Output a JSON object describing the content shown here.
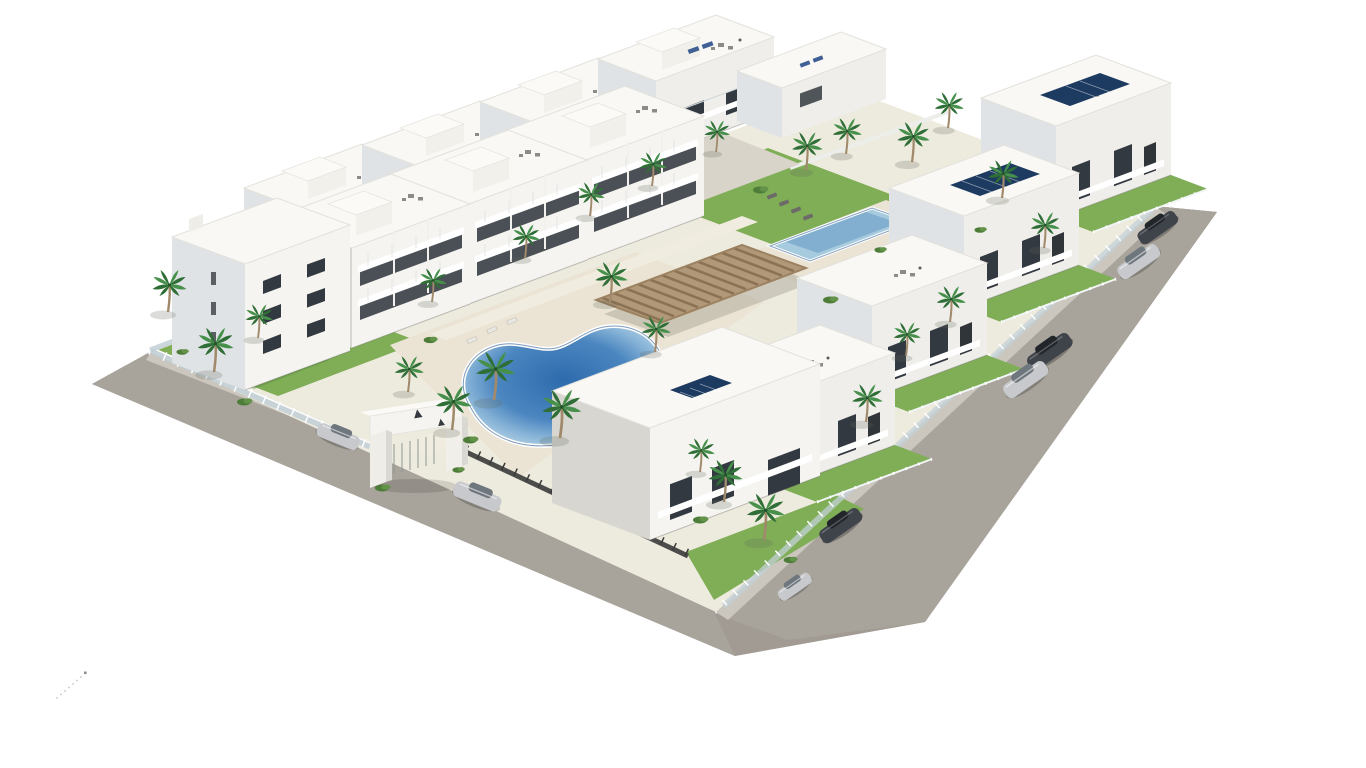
{
  "scene": {
    "description": "Aerial 3D architectural rendering of a white Mediterranean apartment complex with stepped rooftop terraces, solar panels, a free-form pool, a rectangular lap pool, wooden pergola, palm gardens, perimeter road and parked cars",
    "entrance": {
      "logo_glyph": "▲",
      "logo_count": 2
    },
    "palette": {
      "bg": "#ffffff",
      "road": "#a8a39b",
      "road_dark": "#9b968e",
      "sidewalk": "#cbc7bf",
      "sand": "#edeade",
      "alley": "#d8d4c9",
      "deck": "#ebe4d4",
      "path": "#f0ecdf",
      "lawn": "#7fae57",
      "lawn_dark": "#5e8f41",
      "pool_rim": "#27588f",
      "lap_water": "#a6cade",
      "lap_deep": "#6f9fc8",
      "pergola_wood": "#b19878",
      "pergola_slat": "#8b7254",
      "wall_white": "#f5f4f0",
      "wall_face": "#efeeea",
      "wall_side": "#e0e3e5",
      "wall_shade": "#d7d6d1",
      "window_dark": "#333940",
      "glass": "#c9d6dc",
      "rail_dark": "#4c4c4a",
      "solar": "#1d3a60",
      "palm_green": "#2f6e36",
      "palm_green2": "#46904b",
      "trunk": "#a18a6b",
      "car_dark": "#3f434a",
      "car_silver": "#c7c9cc",
      "furniture": "#8c8b87",
      "furniture_dark": "#5f5e5a",
      "blue_furniture": "#3f5f95"
    },
    "inventory": {
      "building_rows": [
        {
          "name": "back-left-row",
          "modules": 5,
          "features": [
            "roof terraces",
            "dining sets",
            "stair bulkheads",
            "blue sunbeds"
          ]
        },
        {
          "name": "front-left-row",
          "modules": 4,
          "features": [
            "tiered balconies",
            "glass railings",
            "corner tower"
          ]
        },
        {
          "name": "right-row",
          "modules": 5,
          "features": [
            "rooftop solar panels",
            "private lawns",
            "roof terraces"
          ]
        }
      ],
      "pools": [
        {
          "type": "free-form",
          "location": "center"
        },
        {
          "type": "rectangular-lap",
          "location": "upper-center"
        }
      ],
      "pergola_count": 1,
      "palm_tree_count": 26,
      "parked_car_count": 8,
      "car_colors": [
        "dark-gray",
        "silver",
        "dark-gray",
        "silver",
        "dark-gray",
        "silver",
        "silver",
        "silver"
      ]
    }
  }
}
